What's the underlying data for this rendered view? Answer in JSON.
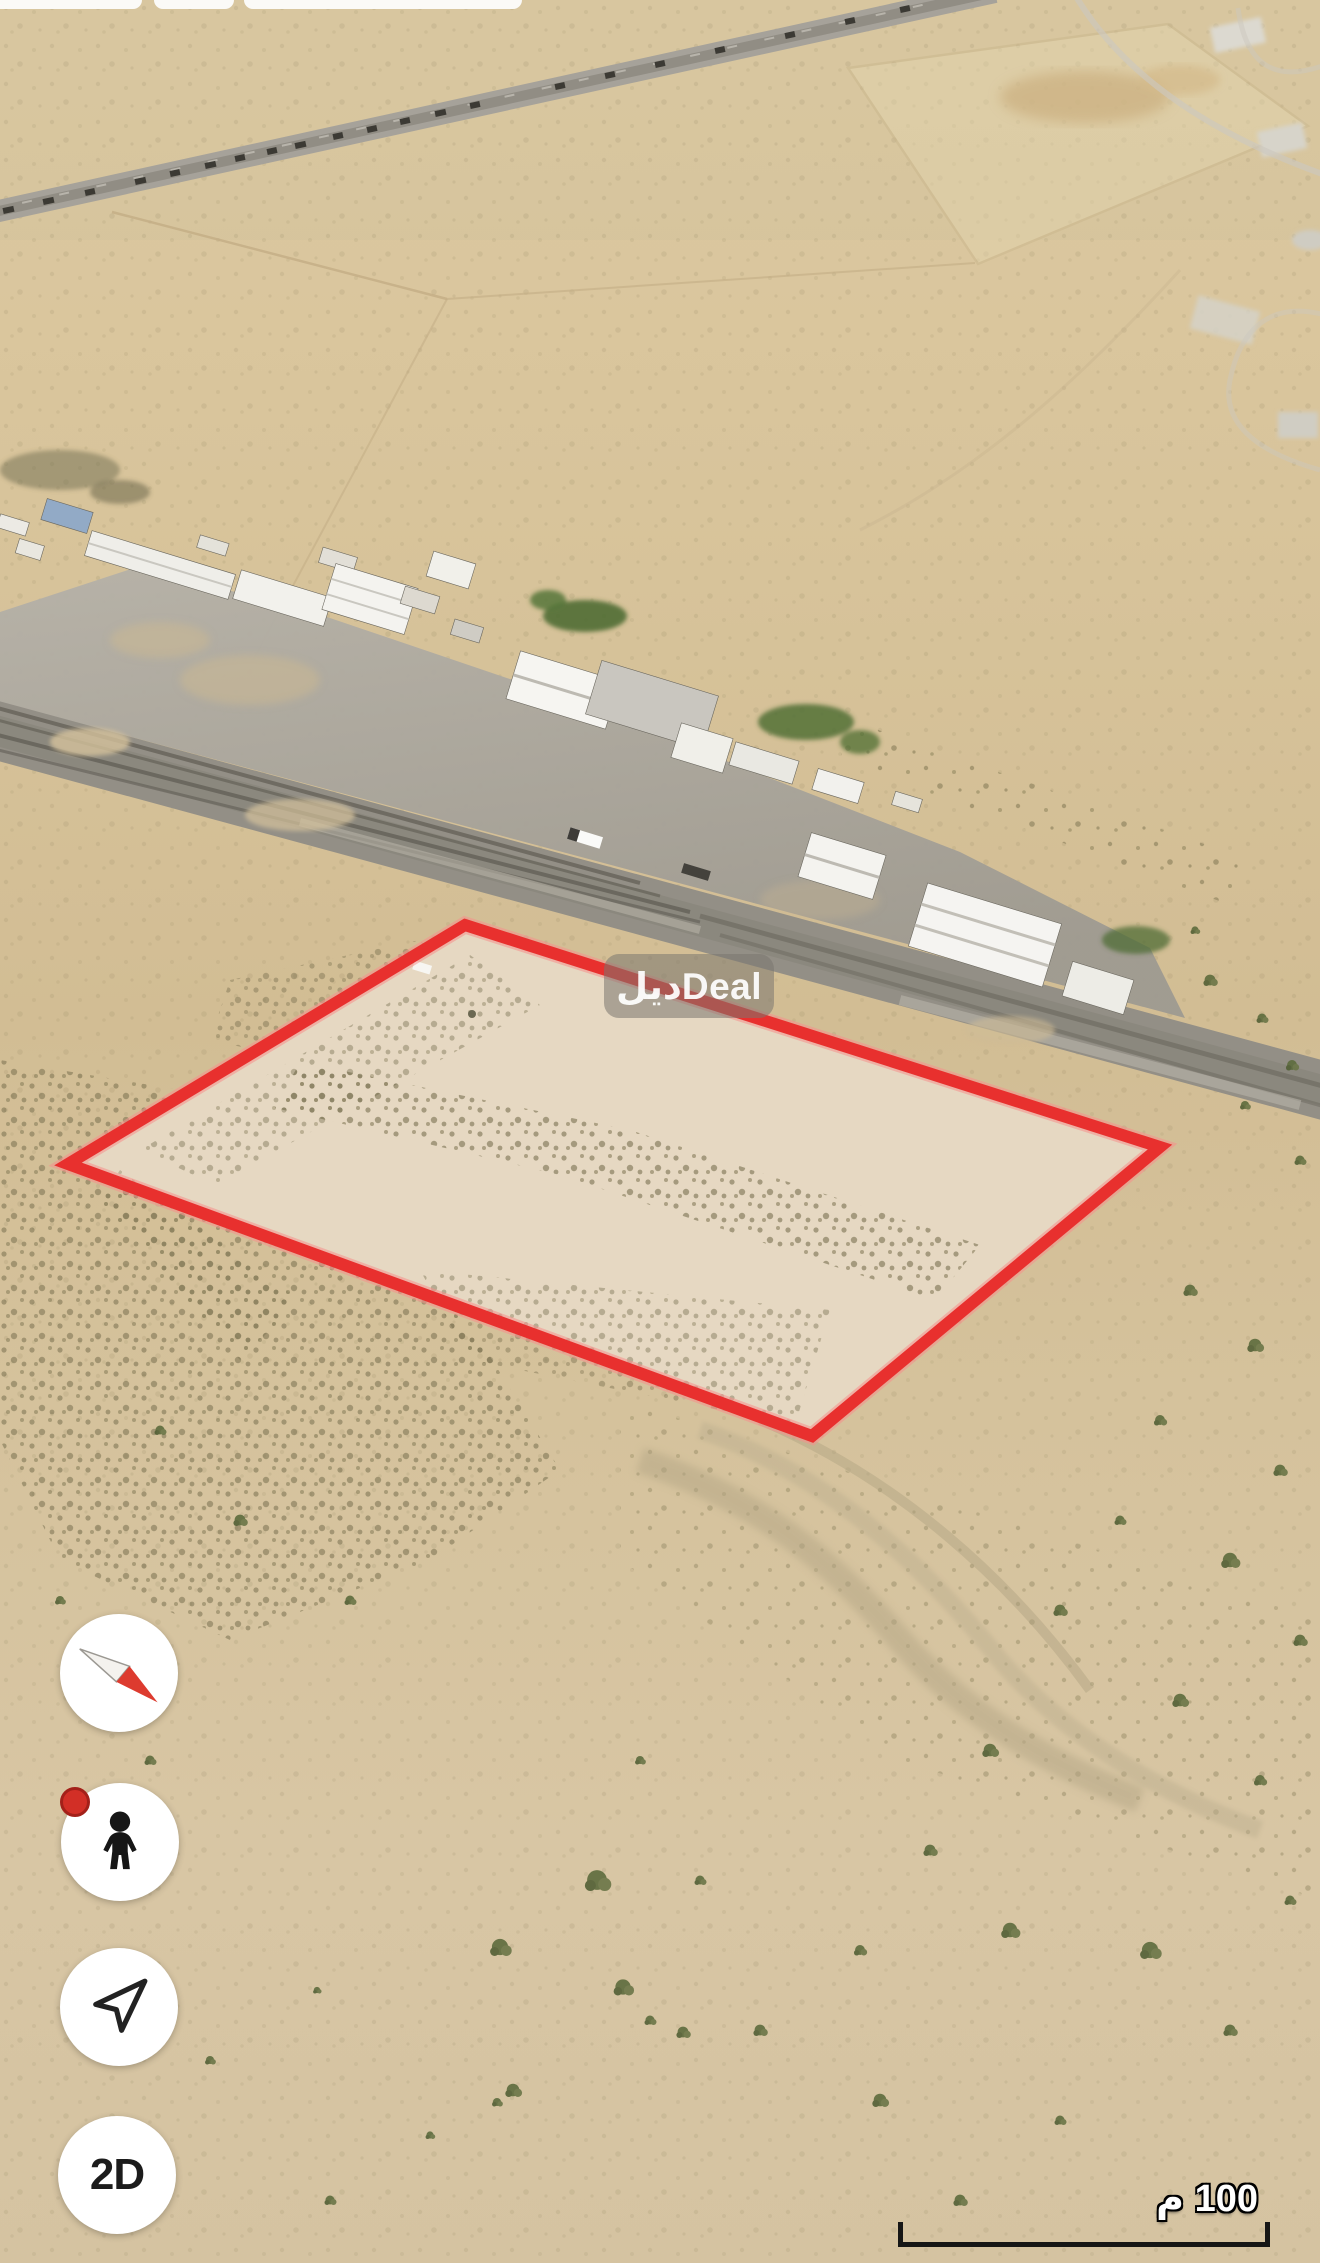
{
  "map": {
    "watermark_label": "ديلDeal",
    "scale": {
      "label": "100 م"
    },
    "controls": {
      "dimension_label": "2D"
    },
    "icons": {
      "compass": "compass-needle-icon",
      "street_view": "pegman-icon",
      "my_location": "navigation-arrow-icon"
    },
    "colors": {
      "plot_outline_red": "#e8302e",
      "street_view_badge_red": "#d22f26",
      "sand_base": "#d6c29a"
    }
  }
}
